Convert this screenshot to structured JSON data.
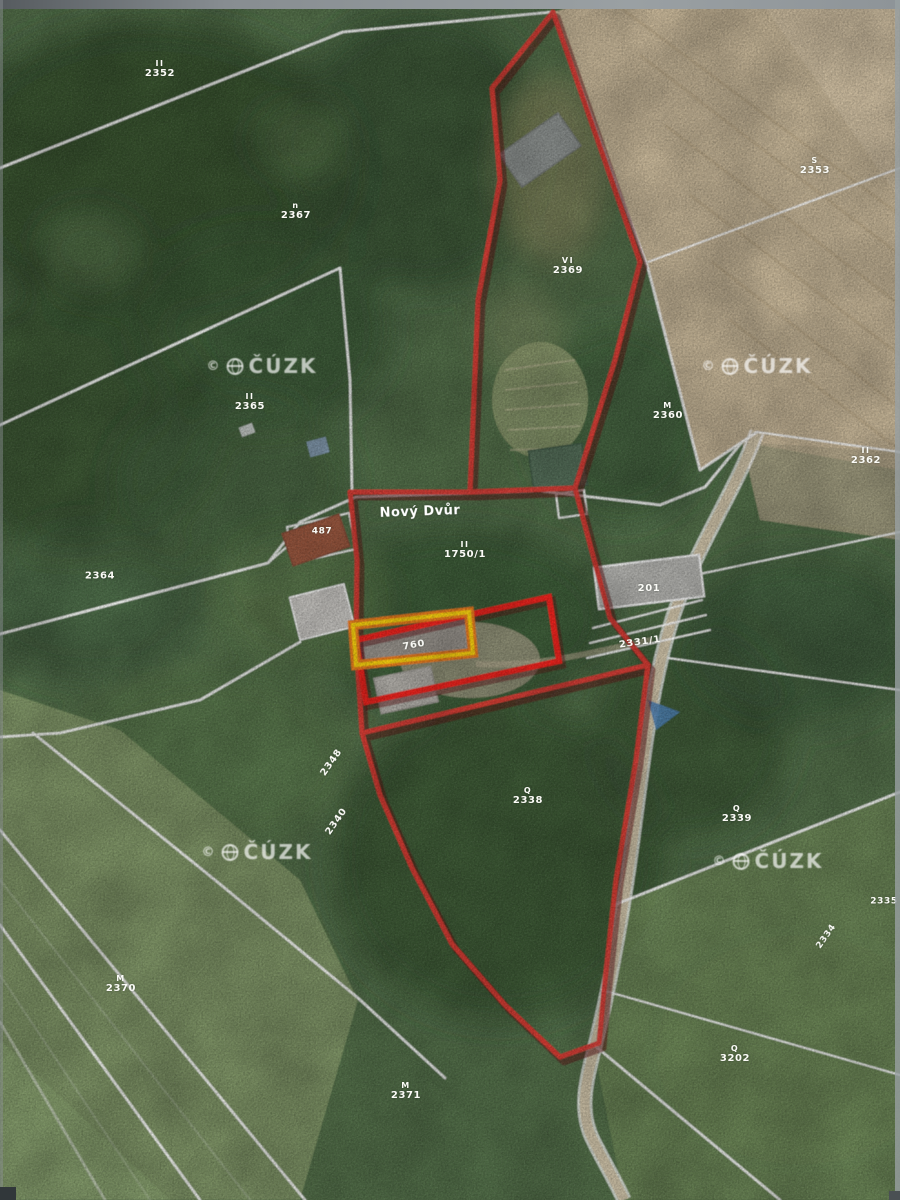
{
  "place": {
    "name": "Nový Dvůr"
  },
  "watermark": {
    "symbol": "©",
    "org": "ČÚZK"
  },
  "labels": [
    {
      "text": "2352",
      "sym": "II"
    },
    {
      "text": "2367",
      "sym": "n"
    },
    {
      "text": "2353",
      "sym": "S"
    },
    {
      "text": "2369",
      "sym": "VI"
    },
    {
      "text": "2365",
      "sym": "II"
    },
    {
      "text": "2360",
      "sym": "M"
    },
    {
      "text": "2362",
      "sym": "II"
    },
    {
      "text": "2364",
      "sym": ""
    },
    {
      "text": "1750/1",
      "sym": "II"
    },
    {
      "text": "487",
      "sym": ""
    },
    {
      "text": "201",
      "sym": ""
    },
    {
      "text": "2331/1",
      "sym": ""
    },
    {
      "text": "760",
      "sym": ""
    },
    {
      "text": "2348",
      "sym": ""
    },
    {
      "text": "2340",
      "sym": ""
    },
    {
      "text": "2338",
      "sym": "Q"
    },
    {
      "text": "2339",
      "sym": "Q"
    },
    {
      "text": "2335",
      "sym": ""
    },
    {
      "text": "2334",
      "sym": ""
    },
    {
      "text": "2370",
      "sym": "M"
    },
    {
      "text": "2371",
      "sym": "M"
    },
    {
      "text": "3202",
      "sym": "Q"
    }
  ],
  "colors": {
    "parcel_boundary_red": "#e23b34",
    "highlight_red": "#f5201b",
    "highlight_orange": "#ef7f1a",
    "highlight_yellow": "#ffd60a",
    "cadastre_line_white": "#ffffff",
    "field_tan": "#c9b899",
    "forest_green": "#3a5634"
  }
}
